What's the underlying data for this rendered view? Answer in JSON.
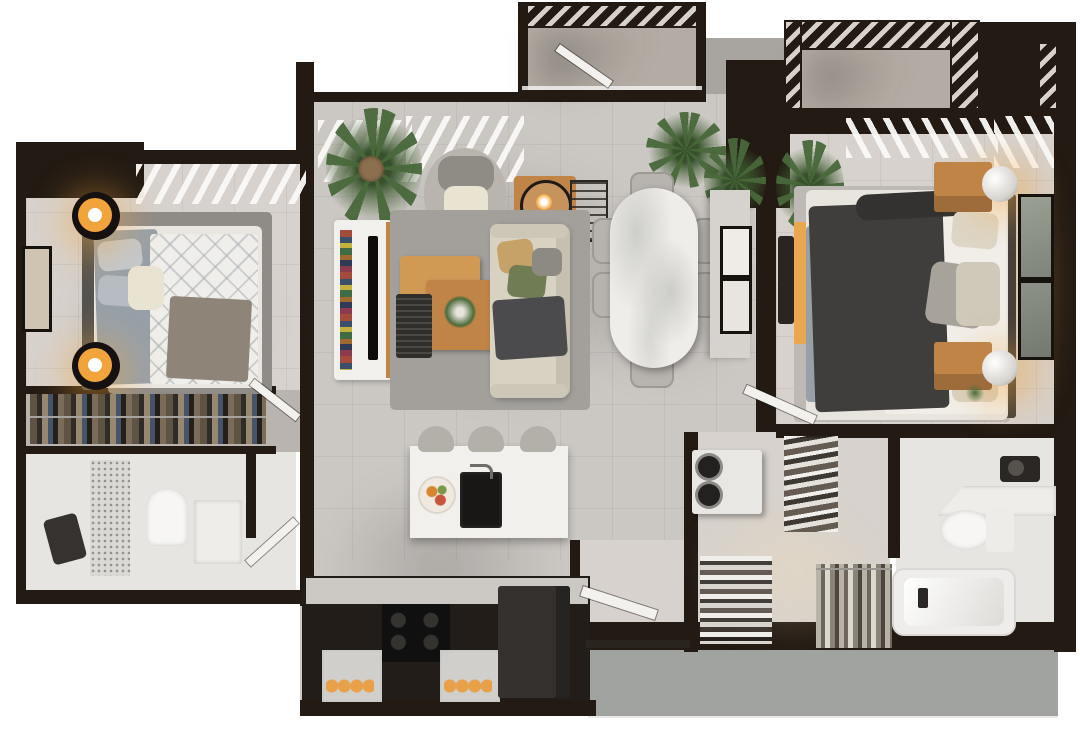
{
  "image": {
    "kind": "3D rendered top-down floor plan of a two-bedroom apartment",
    "width_px": 1080,
    "height_px": 732,
    "background": "white / transparent",
    "text_visible": "none"
  },
  "palette": {
    "wall": "#221a13",
    "floor": "#cbc7c3",
    "floorWarm": "#d7d2cd",
    "floorBath": "#e7e5e2",
    "balcony": "#b3aca4",
    "mat": "#a0a39f",
    "rug": "#a3a09c",
    "rugDark": "#8f8c88",
    "white": "#f2f0ec",
    "cream": "#e9e3d2",
    "marble": "#efede9",
    "wood": "#c08447",
    "woodLight": "#d09a55",
    "orange": "#f2a43c",
    "charcoal": "#434342",
    "sofa": "#d8d2c3",
    "sheet": "#97a0a8",
    "green": "#4c6c3c",
    "greenDark": "#37512c",
    "black": "#141110",
    "metal": "#8b8986"
  },
  "rooms": {
    "balcony_top": {
      "label": "Balcony with slatted pergola",
      "items": [
        "pergola shading",
        "glass railing",
        "open balcony door"
      ]
    },
    "entry_terrace": {
      "label": "Entry terrace",
      "items": [
        "exterior landing"
      ]
    },
    "bedroom_left": {
      "label": "Bedroom (left)",
      "items": [
        "double bed",
        "two round side tables with orange lamps",
        "area rug",
        "framed wall art",
        "closet with hanging clothes",
        "louvered window shades"
      ]
    },
    "bathroom_left": {
      "label": "Bathroom (left)",
      "items": [
        "walk-in shower",
        "frosted glass screen",
        "toilet",
        "vanity sink",
        "swing door"
      ]
    },
    "living_room": {
      "label": "Living room",
      "items": [
        "fabric sofa with cushions and throw",
        "nested wooden coffee tables",
        "round armchair",
        "media console with TV and books",
        "potted banana plant",
        "side table with ring lamp",
        "area rug"
      ]
    },
    "dining_room": {
      "label": "Dining room",
      "items": [
        "marble dining table",
        "six upholstered chairs",
        "gallery picture wall",
        "potted plants",
        "wire magazine rack"
      ]
    },
    "kitchen": {
      "label": "Kitchen",
      "items": [
        "island with sink and breakfast plate",
        "three counter stools",
        "range with four burners and oven",
        "refrigerator",
        "two pastry display cases"
      ]
    },
    "foyer": {
      "label": "Foyer",
      "items": [
        "open entry door",
        "grey doormat landing"
      ]
    },
    "balcony_right": {
      "label": "Balcony (right) with pergola",
      "items": [
        "pergola shading"
      ]
    },
    "bedroom_right": {
      "label": "Bedroom (right)",
      "items": [
        "king bed with charcoal throw",
        "two timber nightstands",
        "globe table lamps",
        "leaning framed artwork",
        "desk bench with orange runner",
        "potted plant",
        "area rug"
      ]
    },
    "walkin_closet": {
      "label": "Walk-in closet / laundry",
      "items": [
        "stacked washer and dryer",
        "slanted shoe shelves",
        "slatted shoe rack",
        "hanging garment rail"
      ]
    },
    "bathroom_right": {
      "label": "Bathroom (right)",
      "items": [
        "corner vanity counter",
        "toilet",
        "bathtub",
        "wall-mounted faucet"
      ]
    }
  }
}
